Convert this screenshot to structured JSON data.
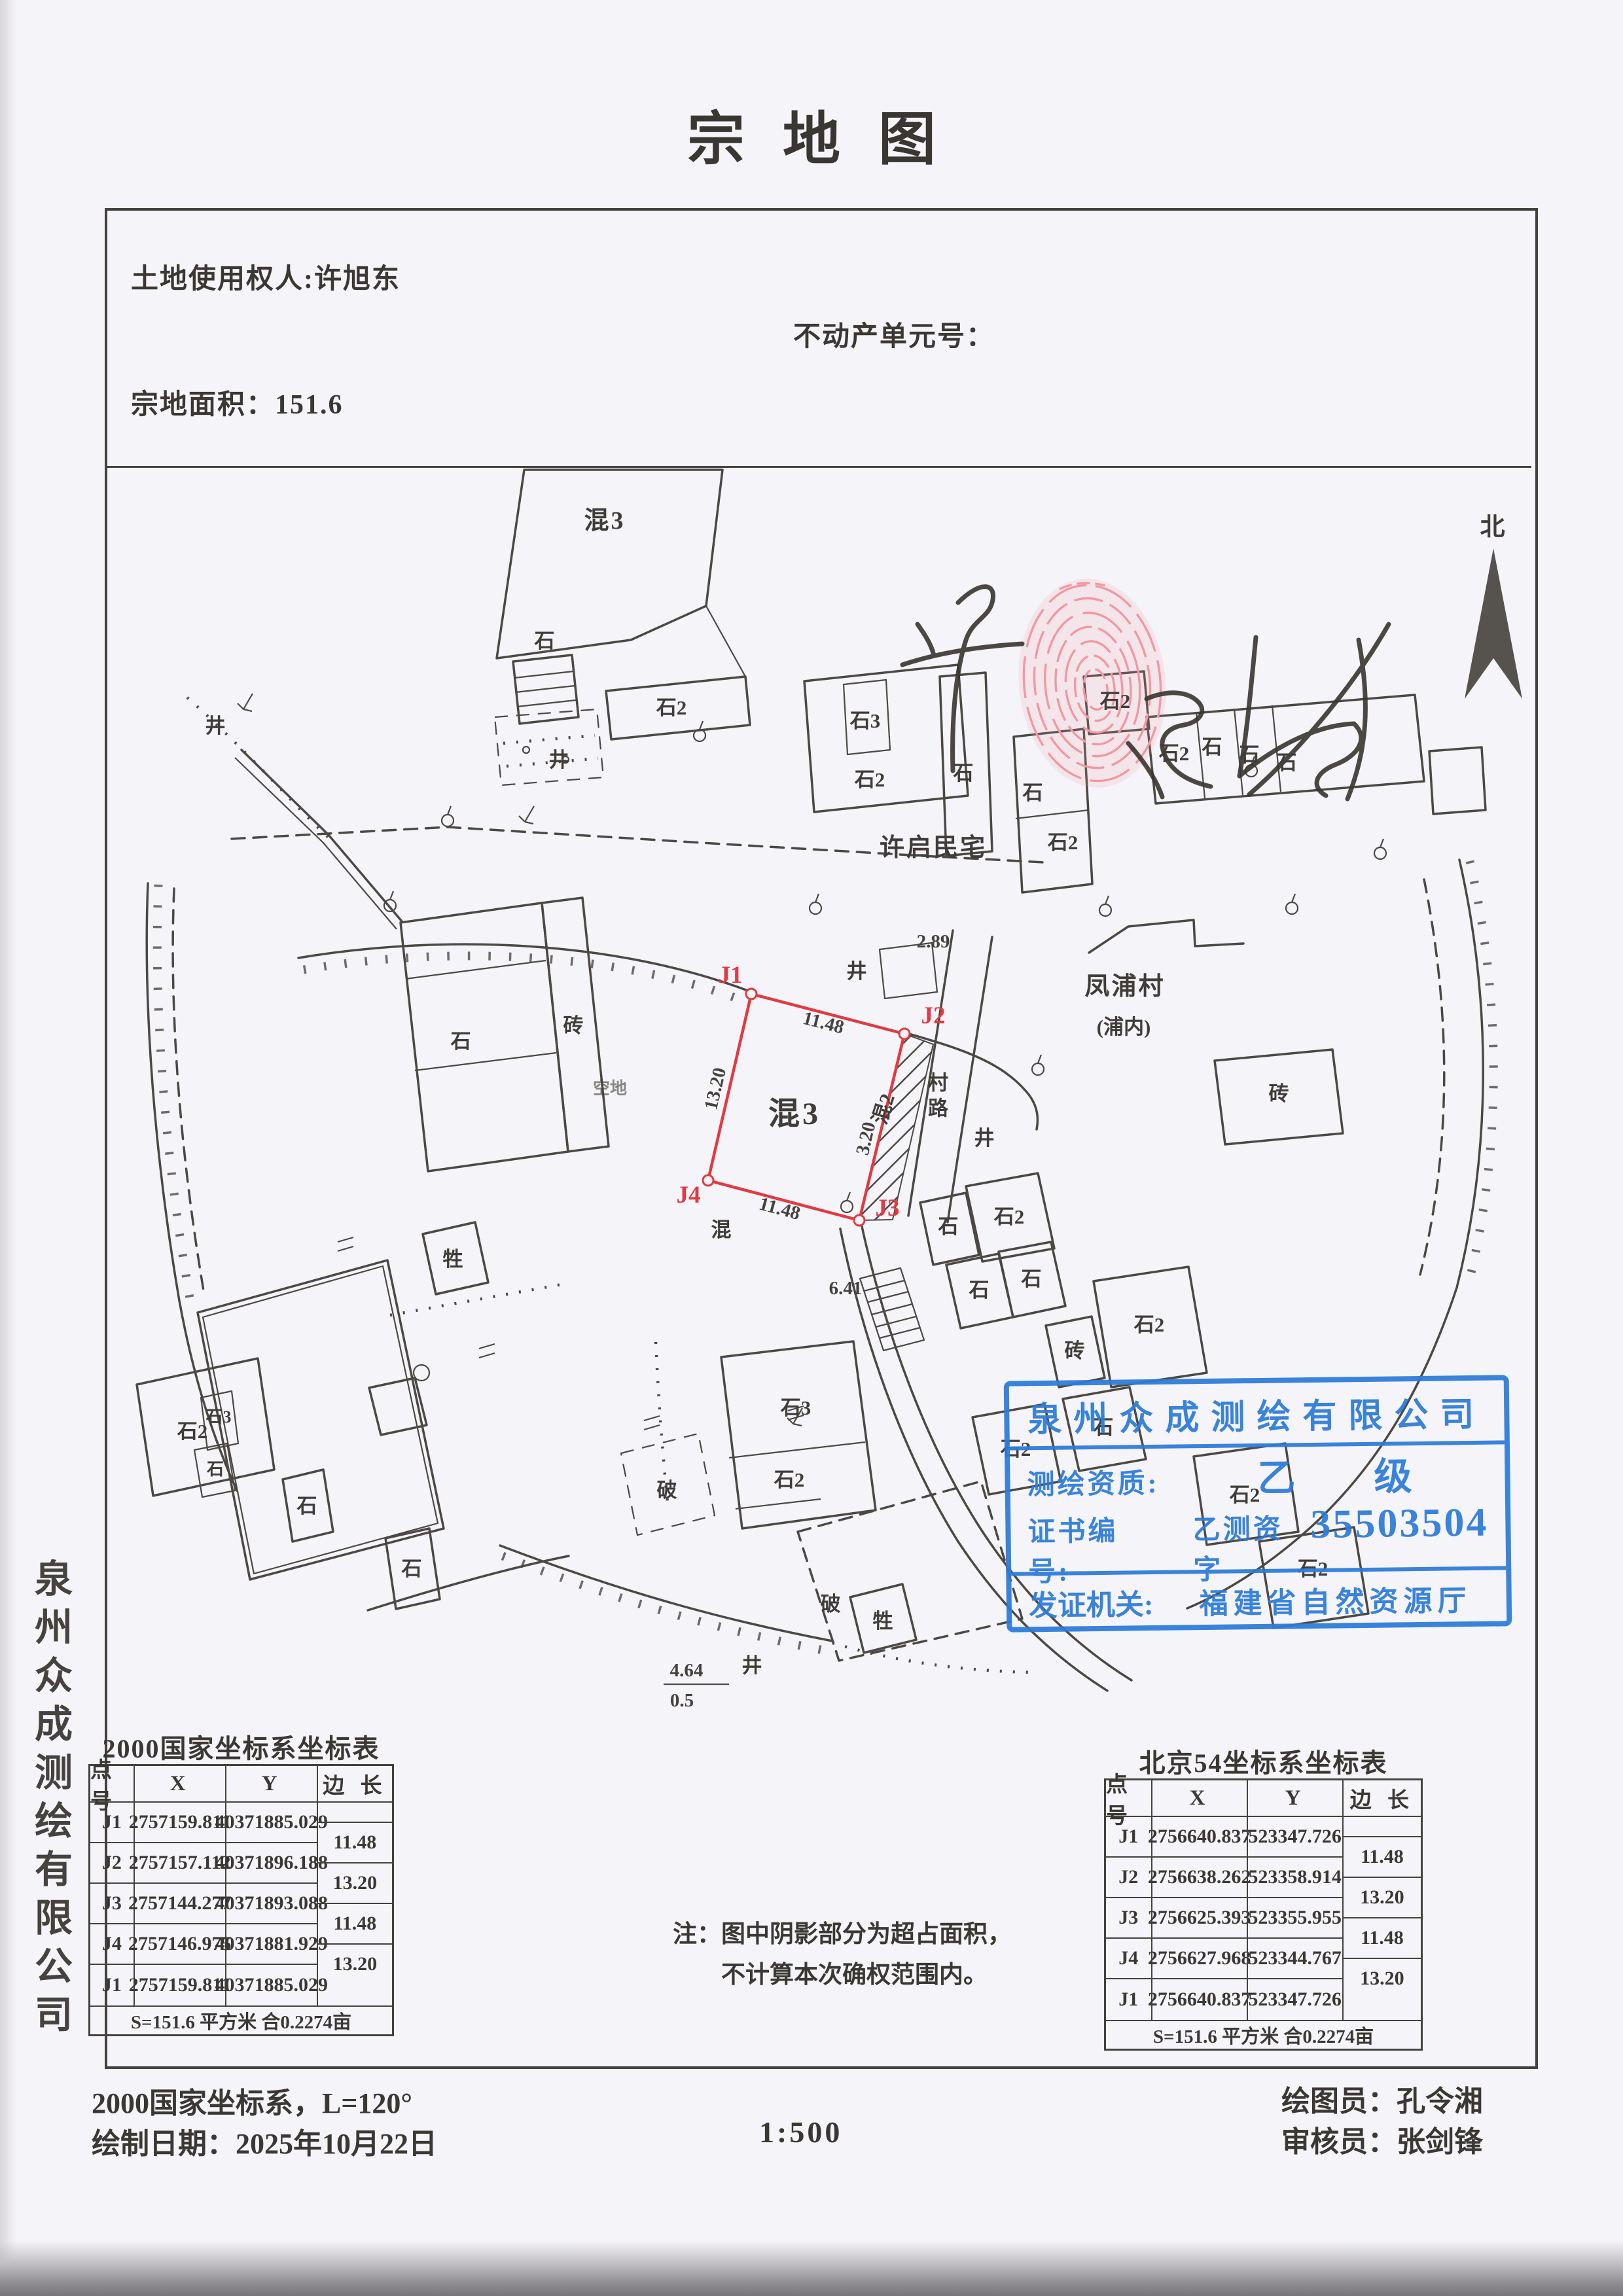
{
  "title": "宗地图",
  "header": {
    "owner": "土地使用权人:许旭东",
    "unit": "不动产单元号：",
    "area": "宗地面积：151.6"
  },
  "sidebar_company": "泉州众成测绘有限公司",
  "signature": "许启民",
  "colors": {
    "stamp_blue": "#2e7cd9",
    "parcel_red": "#e03a43"
  },
  "map": {
    "north": "北",
    "road_label": "村路",
    "red": {
      "p1": "J1",
      "p2": "J2",
      "p3": "J3",
      "p4": "J4",
      "dim_top": "11.48",
      "dim_left": "13.20",
      "dim_right": "3.20",
      "dim_bottom": "11.48"
    },
    "labels": [
      "混3",
      "石",
      "石2",
      "井",
      "石3",
      "石2",
      "石",
      "许启民宅",
      "石",
      "石2",
      "石2",
      "石2",
      "石",
      "石",
      "石",
      "2.89",
      "井",
      "凤浦村",
      "(浦内)",
      "砖",
      "村路",
      "井",
      "石",
      "砖",
      "空地",
      "混3",
      "混2",
      "混",
      "牲",
      "6.41",
      "石",
      "石2",
      "石",
      "石",
      "砖",
      "石2",
      "石2",
      "石",
      "石2",
      "石2",
      "石3",
      "石2",
      "破",
      "破",
      "牲",
      "石2",
      "石3",
      "石",
      "石",
      "石",
      "4.64",
      "0.5",
      "井",
      "井"
    ]
  },
  "stamp": {
    "company": "泉州众成测绘有限公司",
    "grade_label": "测绘资质:",
    "grade_value": "乙",
    "grade_suffix": "级",
    "cert_label": "证书编号:",
    "cert_prefix": "乙测资字",
    "cert_number": "35503504",
    "issuer_label": "发证机关:",
    "issuer_value": "福建省自然资源厅"
  },
  "tables": [
    {
      "title": "2000国家坐标系坐标表",
      "headers": [
        "点 号",
        "X",
        "Y",
        "边 长"
      ],
      "rows": [
        [
          "J1",
          "2757159.811",
          "40371885.029"
        ],
        [
          "J2",
          "2757157.112",
          "40371896.188"
        ],
        [
          "J3",
          "2757144.277",
          "40371893.088"
        ],
        [
          "J4",
          "2757146.975",
          "40371881.929"
        ],
        [
          "J1",
          "2757159.811",
          "40371885.029"
        ]
      ],
      "edges": [
        "11.48",
        "13.20",
        "11.48",
        "13.20"
      ],
      "footer": "S=151.6 平方米 合0.2274亩"
    },
    {
      "title": "北京54坐标系坐标表",
      "headers": [
        "点 号",
        "X",
        "Y",
        "边 长"
      ],
      "rows": [
        [
          "J1",
          "2756640.837",
          "523347.726"
        ],
        [
          "J2",
          "2756638.262",
          "523358.914"
        ],
        [
          "J3",
          "2756625.393",
          "523355.955"
        ],
        [
          "J4",
          "2756627.968",
          "523344.767"
        ],
        [
          "J1",
          "2756640.837",
          "523347.726"
        ]
      ],
      "edges": [
        "11.48",
        "13.20",
        "11.48",
        "13.20"
      ],
      "footer": "S=151.6 平方米 合0.2274亩"
    }
  ],
  "note": {
    "line1": "注：图中阴影部分为超占面积，",
    "line2": "不计算本次确权范围内。"
  },
  "footer": {
    "coord_system": "2000国家坐标系，L=120°",
    "draw_date": "绘制日期：2025年10月22日",
    "scale": "1:500",
    "drafter": "绘图员：孔令湘",
    "reviewer": "审核员：张剑锋"
  }
}
